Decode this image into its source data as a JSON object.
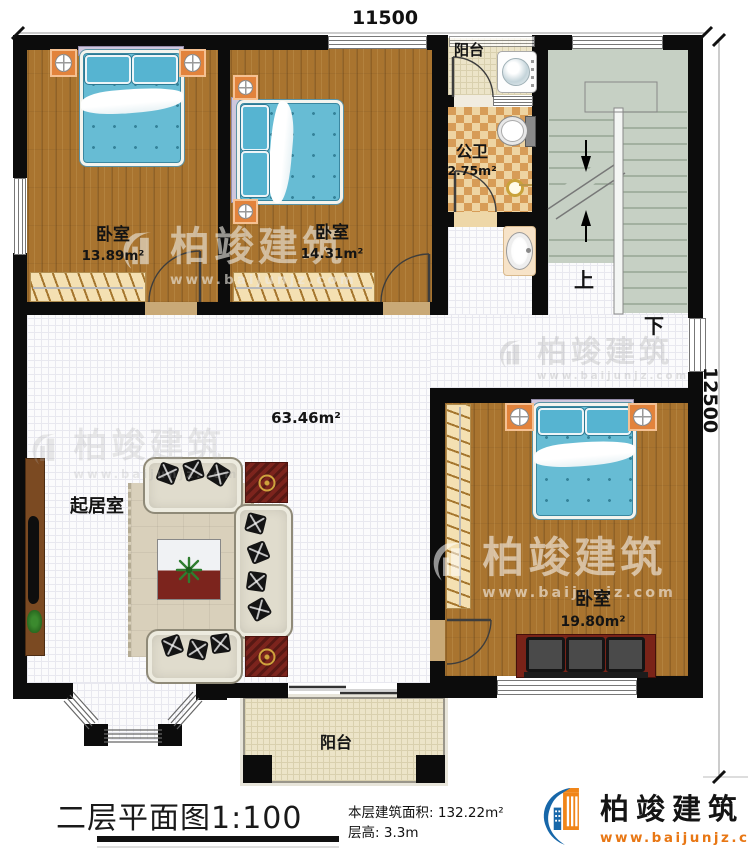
{
  "plan": {
    "dim_top": "11500",
    "dim_right": "12500",
    "stairs_up": "上",
    "stairs_down": "下"
  },
  "rooms": {
    "bedroom1": {
      "name": "卧室",
      "area": "13.89m²"
    },
    "bedroom2": {
      "name": "卧室",
      "area": "14.31m²"
    },
    "bedroom3": {
      "name": "卧室",
      "area": "19.80m²"
    },
    "living_room": {
      "name": "起居室",
      "area": "63.46m²"
    },
    "bathroom": {
      "name": "公卫",
      "area": "2.75m²"
    },
    "balcony_top": {
      "name": "阳台"
    },
    "balcony_bottom": {
      "name": "阳台"
    }
  },
  "titleblock": {
    "title": "二层平面图",
    "scale": "1:100",
    "floor_area_label": "本层建筑面积:",
    "floor_area_value": "132.22m²",
    "floor_height_label": "层高:",
    "floor_height_value": "3.3m"
  },
  "brand": {
    "name": "柏竣建筑",
    "website": "www.baijunjz.com",
    "color_blue": "#1767a9",
    "color_orange": "#f08519"
  },
  "watermark": {
    "name": "柏竣建筑",
    "website": "www.baijunjz.com"
  },
  "colors": {
    "wall": "#0c0c0c",
    "wood_floor": "#a9742f",
    "tile_floor": "#fbfbfc",
    "bath_checker_light": "#eed4a2",
    "bath_checker_dark": "#d79c57",
    "balcony_tile": "#ece4c8",
    "stair_floor": "#c6d0c4",
    "bed_blue": "#67bcd4"
  }
}
